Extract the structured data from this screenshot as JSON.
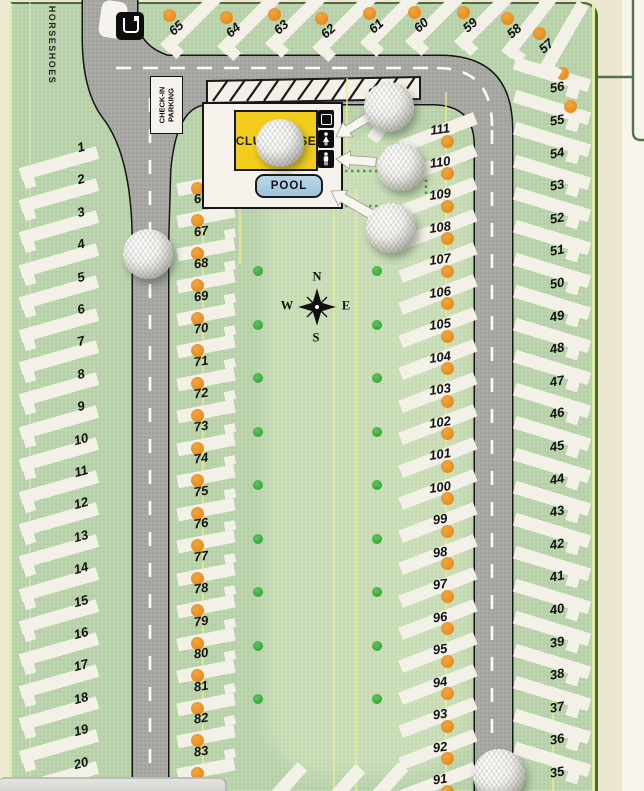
{
  "labels": {
    "horseshoes": "HORSESHOES",
    "check_in_line1": "CHECK-IN",
    "check_in_line2": "PARKING",
    "pool": "POOL",
    "building": "CLUBHOUSE"
  },
  "compass": {
    "north": "N",
    "south": "S",
    "east": "E",
    "west": "W"
  },
  "sites": {
    "left_column": [
      "1",
      "2",
      "3",
      "4",
      "5",
      "6",
      "7",
      "8",
      "9",
      "10",
      "11",
      "12",
      "13",
      "14",
      "15",
      "16",
      "17",
      "18",
      "19",
      "20"
    ],
    "middle_left_column": [
      "66",
      "67",
      "68",
      "69",
      "70",
      "71",
      "72",
      "73",
      "74",
      "75",
      "76",
      "77",
      "78",
      "79",
      "80",
      "81",
      "82",
      "83",
      "84"
    ],
    "middle_right_column": [
      "91",
      "92",
      "93",
      "94",
      "95",
      "96",
      "97",
      "98",
      "99",
      "100",
      "101",
      "102",
      "103",
      "104",
      "105",
      "106",
      "107",
      "108",
      "109",
      "110",
      "111",
      "112"
    ],
    "right_column": [
      "35",
      "36",
      "37",
      "38",
      "39",
      "40",
      "41",
      "42",
      "43",
      "44",
      "45",
      "46",
      "47",
      "48",
      "49",
      "50",
      "51",
      "52",
      "53",
      "54",
      "55",
      "56"
    ],
    "top_fan": [
      "65",
      "64",
      "63",
      "62",
      "61",
      "60",
      "59",
      "58",
      "57"
    ],
    "right_column_sites_with_dots": [
      "55",
      "56"
    ]
  },
  "markers": {
    "golf_balls": [
      {
        "x": 280,
        "y": 143,
        "r": 24
      },
      {
        "x": 389,
        "y": 107,
        "r": 25
      },
      {
        "x": 401,
        "y": 167,
        "r": 24
      },
      {
        "x": 391,
        "y": 228,
        "r": 25
      },
      {
        "x": 148,
        "y": 254,
        "r": 25
      },
      {
        "x": 499,
        "y": 775,
        "r": 26
      }
    ]
  },
  "icons": [
    "dump-station-icon",
    "laundry-icon",
    "womens-restroom-icon",
    "mens-restroom-icon",
    "compass-rose-icon"
  ],
  "colors": {
    "map_green": "#b6d1a8",
    "road_gray": "#a9a9a5",
    "site_white": "#f3f0e7",
    "hookup_orange": "#e28a1d",
    "tree_green": "#36a23c",
    "building_yellow": "#f2cd1e",
    "pool_blue": "#a9cbe2",
    "boundary_yellow": "#f3ec8a",
    "frame_cream": "#ece7d0"
  }
}
